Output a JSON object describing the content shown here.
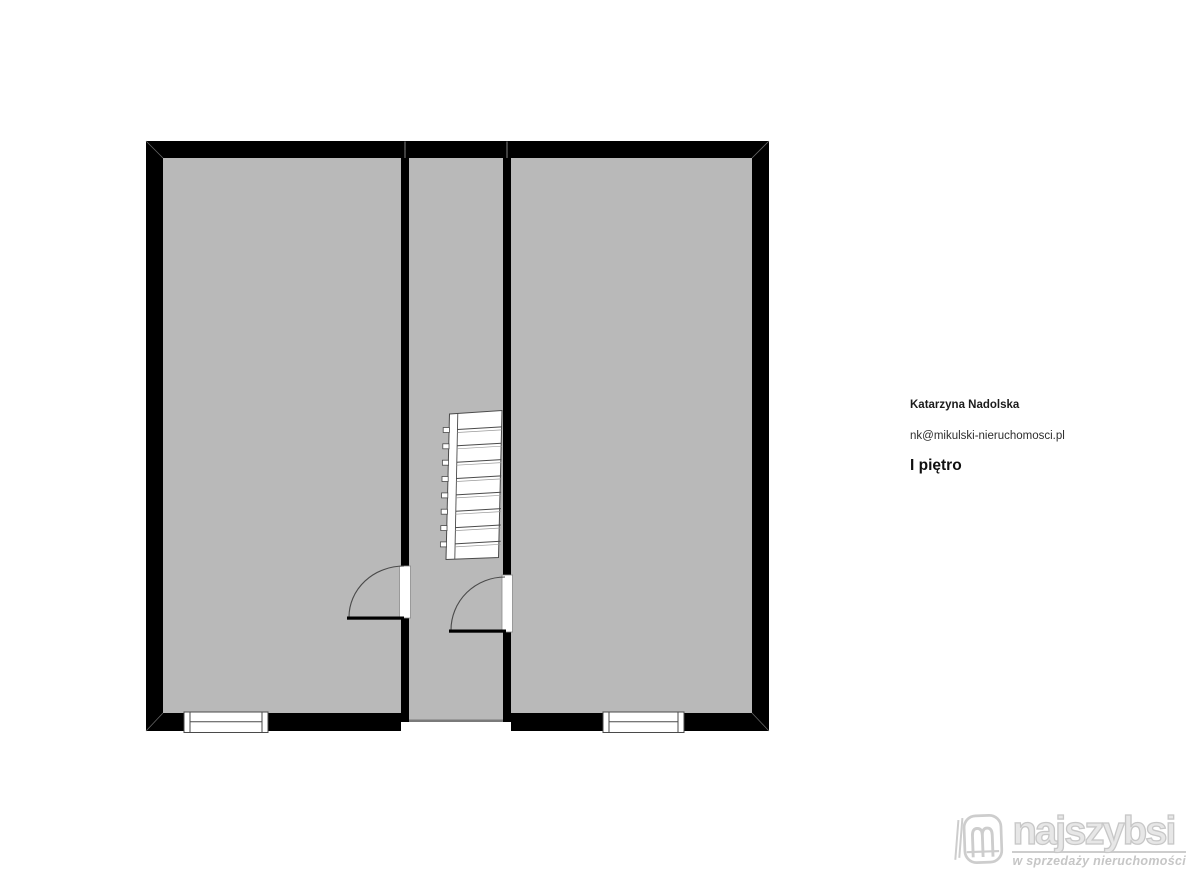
{
  "page": {
    "background": "#ffffff"
  },
  "contact": {
    "name": "Katarzyna Nadolska",
    "email": "nk@mikulski-nieruchomosci.pl",
    "floor_label": "I piętro"
  },
  "branding": {
    "logo_text": "najszybsi",
    "tagline": "w sprzedaży nieruchomości",
    "logo_color": "#cccccc"
  },
  "floorplan": {
    "type": "floor-plan",
    "floor_shown": "I piętro",
    "colors": {
      "wall": "#000000",
      "room_fill": "#b9b9b9",
      "feature_outline": "#4a4a4a",
      "threshold": "#7a7a7a",
      "opening": "#ffffff"
    },
    "features": {
      "rooms": [
        "room-left",
        "stair-hall",
        "room-right"
      ],
      "staircase": "staircase-in-hall",
      "doors": [
        "door-room-left",
        "door-room-right"
      ],
      "windows": [
        "window-room-left",
        "window-room-right"
      ],
      "openings": [
        "hall-bottom-opening"
      ]
    }
  }
}
